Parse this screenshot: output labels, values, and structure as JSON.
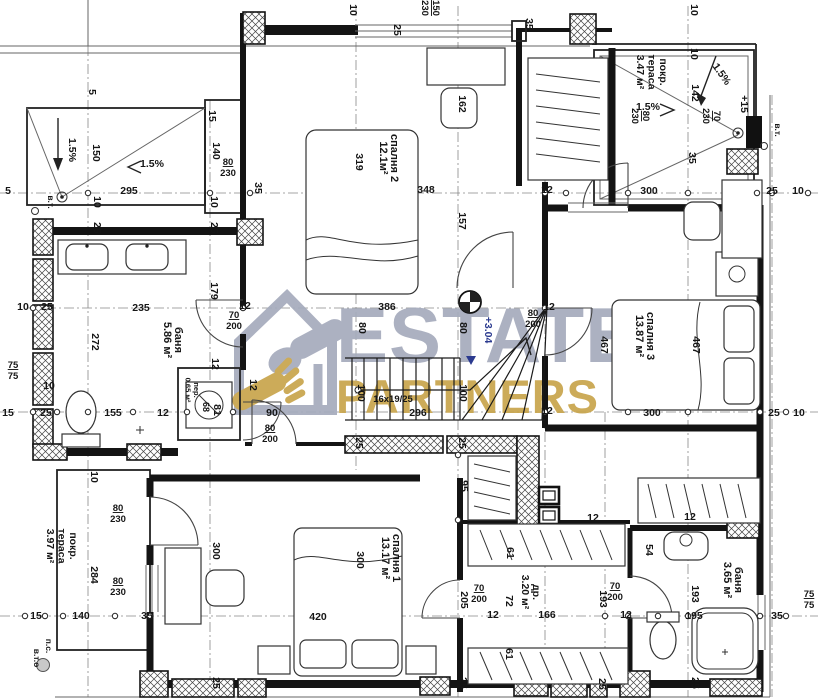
{
  "watermark": {
    "line1": "ESTATE",
    "line2": "PARTNERS",
    "gray": "#a6abbc",
    "gold": "#c8a44c"
  },
  "plan": {
    "rooms_note": "Bulgarian room labels: спалня=bedroom, баня=bathroom, покр. тераса=covered terrace, др.=closet, пер.=laundry",
    "labels": [
      {
        "t": "10",
        "x": 350,
        "y": 10,
        "r": 90
      },
      {
        "t": "25",
        "x": 394,
        "y": 30,
        "r": 90
      },
      {
        "ls": [
          "150",
          "230"
        ],
        "x": 433,
        "y": 8,
        "r": 90,
        "u": 1,
        "s": 9.5
      },
      {
        "t": "35",
        "x": 526,
        "y": 24,
        "r": 90
      },
      {
        "t": "10",
        "x": 691,
        "y": 10,
        "r": 90
      },
      {
        "t": "10",
        "x": 691,
        "y": 54,
        "r": 90
      },
      {
        "t": "1.5%",
        "x": 719,
        "y": 76,
        "r": 55
      },
      {
        "t": "142",
        "x": 692,
        "y": 93,
        "r": 90
      },
      {
        "t": "+15",
        "x": 741,
        "y": 104,
        "r": 90
      },
      {
        "t": "в.т.",
        "x": 775,
        "y": 130,
        "r": 90,
        "s": 8.5
      },
      {
        "ls": [
          "80",
          "230"
        ],
        "x": 643,
        "y": 116,
        "r": 90,
        "u": 1,
        "s": 9.5
      },
      {
        "ls": [
          "70",
          "230"
        ],
        "x": 714,
        "y": 116,
        "r": 90,
        "u": 1,
        "s": 9.5
      },
      {
        "t": "1.5%",
        "x": 648,
        "y": 110,
        "r": 0
      },
      {
        "t": "35",
        "x": 689,
        "y": 158,
        "r": 90
      },
      {
        "ls": [
          "покр.",
          "тераса",
          "3.47 м²"
        ],
        "x": 660,
        "y": 72,
        "r": 90,
        "n": "room-label",
        "s": 10.5,
        "lh": 11.5
      },
      {
        "t": "300",
        "x": 649,
        "y": 194,
        "r": 0
      },
      {
        "t": "25",
        "x": 772,
        "y": 194,
        "r": 0
      },
      {
        "t": "10",
        "x": 798,
        "y": 194,
        "r": 0
      },
      {
        "t": "5",
        "x": 89,
        "y": 92,
        "r": 90
      },
      {
        "t": "15",
        "x": 209,
        "y": 116,
        "r": 90
      },
      {
        "t": "1.5%",
        "x": 69,
        "y": 150,
        "r": 90
      },
      {
        "t": "150",
        "x": 93,
        "y": 153,
        "r": 90
      },
      {
        "t": "140",
        "x": 213,
        "y": 151,
        "r": 90
      },
      {
        "ls": [
          "80",
          "230"
        ],
        "x": 228,
        "y": 165,
        "r": 0,
        "u": 1,
        "s": 9.5
      },
      {
        "t": "1.5%",
        "x": 152,
        "y": 167,
        "r": 0
      },
      {
        "t": "295",
        "x": 129,
        "y": 194,
        "r": 0
      },
      {
        "t": "35",
        "x": 255,
        "y": 188,
        "r": 90
      },
      {
        "t": "5",
        "x": 8,
        "y": 194,
        "r": 0
      },
      {
        "t": "в.т.",
        "x": 48,
        "y": 202,
        "r": 90,
        "s": 8.5
      },
      {
        "t": "10",
        "x": 94,
        "y": 202,
        "r": 90
      },
      {
        "t": "10",
        "x": 211,
        "y": 202,
        "r": 90
      },
      {
        "t": "25",
        "x": 94,
        "y": 228,
        "r": 90
      },
      {
        "t": "25",
        "x": 211,
        "y": 228,
        "r": 90
      },
      {
        "ls": [
          "спалня 2",
          "12.1м²"
        ],
        "x": 391,
        "y": 158,
        "r": 90,
        "n": "room-label",
        "s": 11
      },
      {
        "t": "319",
        "x": 356,
        "y": 162,
        "r": 90
      },
      {
        "t": "162",
        "x": 459,
        "y": 104,
        "r": 90
      },
      {
        "t": "348",
        "x": 426,
        "y": 193,
        "r": 0
      },
      {
        "t": "157",
        "x": 459,
        "y": 221,
        "r": 90
      },
      {
        "t": "12",
        "x": 547,
        "y": 193,
        "r": 0
      },
      {
        "t": "12",
        "x": 245,
        "y": 309,
        "r": 0
      },
      {
        "t": "386",
        "x": 387,
        "y": 310,
        "r": 0
      },
      {
        "t": "80",
        "x": 359,
        "y": 328,
        "r": 90
      },
      {
        "t": "80",
        "x": 460,
        "y": 328,
        "r": 90
      },
      {
        "t": "+3.04",
        "x": 485,
        "y": 330,
        "r": 90,
        "c": "lvl"
      },
      {
        "t": "12",
        "x": 549,
        "y": 310,
        "r": 0
      },
      {
        "ls": [
          "80",
          "200"
        ],
        "x": 533,
        "y": 316,
        "r": 0,
        "u": 1,
        "s": 9.5
      },
      {
        "t": "12",
        "x": 250,
        "y": 385,
        "r": 90
      },
      {
        "t": "90",
        "x": 272,
        "y": 416,
        "r": 0
      },
      {
        "t": "16x19/25",
        "x": 393,
        "y": 402,
        "r": 0,
        "s": 9.5
      },
      {
        "t": "100",
        "x": 358,
        "y": 393,
        "r": 90
      },
      {
        "t": "100",
        "x": 460,
        "y": 393,
        "r": 90
      },
      {
        "t": "296",
        "x": 418,
        "y": 416,
        "r": 0
      },
      {
        "t": "12",
        "x": 547,
        "y": 414,
        "r": 0
      },
      {
        "t": "25",
        "x": 356,
        "y": 443,
        "r": 90
      },
      {
        "t": "25",
        "x": 459,
        "y": 443,
        "r": 90
      },
      {
        "t": "95",
        "x": 461,
        "y": 486,
        "r": 90
      },
      {
        "t": "12",
        "x": 593,
        "y": 521,
        "r": 0
      },
      {
        "t": "12",
        "x": 690,
        "y": 520,
        "r": 0
      },
      {
        "t": "235",
        "x": 141,
        "y": 311,
        "r": 0
      },
      {
        "t": "179",
        "x": 211,
        "y": 291,
        "r": 90
      },
      {
        "ls": [
          "70",
          "200"
        ],
        "x": 234,
        "y": 318,
        "r": 0,
        "u": 1,
        "s": 9.5
      },
      {
        "ls": [
          "баня",
          "5.86 м²"
        ],
        "x": 175,
        "y": 340,
        "r": 90,
        "n": "room-label",
        "s": 11
      },
      {
        "t": "272",
        "x": 92,
        "y": 342,
        "r": 90
      },
      {
        "t": "12",
        "x": 212,
        "y": 364,
        "r": 90
      },
      {
        "ls": [
          "75",
          "75"
        ],
        "x": 13,
        "y": 368,
        "r": 0,
        "u": 1,
        "s": 9.5
      },
      {
        "t": "10",
        "x": 49,
        "y": 389,
        "r": 0
      },
      {
        "t": "155",
        "x": 113,
        "y": 416,
        "r": 0
      },
      {
        "t": "12",
        "x": 163,
        "y": 416,
        "r": 0
      },
      {
        "t": "15",
        "x": 8,
        "y": 416,
        "r": 0
      },
      {
        "t": "25",
        "x": 46,
        "y": 416,
        "r": 0
      },
      {
        "ls": [
          "пер.",
          "0.65 м²"
        ],
        "x": 194,
        "y": 390,
        "r": 90,
        "s": 7.5,
        "n": "room-label",
        "lh": 8.5
      },
      {
        "t": "68",
        "x": 203,
        "y": 407,
        "r": 90,
        "s": 9
      },
      {
        "t": "81",
        "x": 214,
        "y": 410,
        "r": 90
      },
      {
        "ls": [
          "80",
          "200"
        ],
        "x": 270,
        "y": 431,
        "r": 0,
        "u": 1,
        "s": 9.5
      },
      {
        "t": "10",
        "x": 91,
        "y": 477,
        "r": 90
      },
      {
        "ls": [
          "80",
          "230"
        ],
        "x": 118,
        "y": 511,
        "r": 0,
        "u": 1,
        "s": 9.5
      },
      {
        "ls": [
          "покр.",
          "тераса",
          "3.97 м²"
        ],
        "x": 70,
        "y": 546,
        "r": 90,
        "n": "room-label",
        "s": 10.5,
        "lh": 11.5
      },
      {
        "t": "284",
        "x": 91,
        "y": 575,
        "r": 90
      },
      {
        "ls": [
          "80",
          "230"
        ],
        "x": 118,
        "y": 584,
        "r": 0,
        "u": 1,
        "s": 9.5
      },
      {
        "t": "15",
        "x": 36,
        "y": 619,
        "r": 0
      },
      {
        "t": "140",
        "x": 81,
        "y": 619,
        "r": 0
      },
      {
        "t": "35",
        "x": 147,
        "y": 619,
        "r": 0
      },
      {
        "t": "300",
        "x": 213,
        "y": 551,
        "r": 90
      },
      {
        "t": "п.с.",
        "x": 46,
        "y": 646,
        "r": 90,
        "s": 8.5
      },
      {
        "t": "в.т.о",
        "x": 34,
        "y": 658,
        "r": 90,
        "s": 8.5
      },
      {
        "t": "25",
        "x": 213,
        "y": 683,
        "r": 90
      },
      {
        "ls": [
          "спалня 1",
          "13.17 м²"
        ],
        "x": 393,
        "y": 558,
        "r": 90,
        "n": "room-label",
        "s": 11
      },
      {
        "t": "300",
        "x": 357,
        "y": 560,
        "r": 90
      },
      {
        "t": "420",
        "x": 318,
        "y": 620,
        "r": 0
      },
      {
        "t": "205",
        "x": 461,
        "y": 600,
        "r": 90
      },
      {
        "ls": [
          "70",
          "200"
        ],
        "x": 479,
        "y": 591,
        "r": 0,
        "u": 1,
        "s": 9.5
      },
      {
        "t": "12",
        "x": 493,
        "y": 618,
        "r": 0
      },
      {
        "t": "72",
        "x": 506,
        "y": 601,
        "r": 90
      },
      {
        "ls": [
          "др.",
          "3.20 м²"
        ],
        "x": 533,
        "y": 592,
        "r": 90,
        "n": "room-label",
        "s": 10.5
      },
      {
        "t": "166",
        "x": 547,
        "y": 618,
        "r": 0
      },
      {
        "t": "61",
        "x": 506,
        "y": 654,
        "r": 90
      },
      {
        "t": "61",
        "x": 507,
        "y": 553,
        "r": 90
      },
      {
        "t": "25",
        "x": 460,
        "y": 683,
        "r": 90
      },
      {
        "t": "25",
        "x": 599,
        "y": 684,
        "r": 90
      },
      {
        "t": "54",
        "x": 646,
        "y": 550,
        "r": 90
      },
      {
        "t": "193",
        "x": 600,
        "y": 599,
        "r": 90
      },
      {
        "ls": [
          "70",
          "200"
        ],
        "x": 615,
        "y": 589,
        "r": 0,
        "u": 1,
        "s": 9.5
      },
      {
        "t": "12",
        "x": 626,
        "y": 618,
        "r": 0
      },
      {
        "ls": [
          "баня",
          "3.65 м²"
        ],
        "x": 735,
        "y": 580,
        "r": 90,
        "n": "room-label",
        "s": 11
      },
      {
        "t": "193",
        "x": 692,
        "y": 594,
        "r": 90
      },
      {
        "t": "195",
        "x": 694,
        "y": 619,
        "r": 0
      },
      {
        "t": "35",
        "x": 777,
        "y": 619,
        "r": 0
      },
      {
        "ls": [
          "75",
          "75"
        ],
        "x": 809,
        "y": 597,
        "r": 0,
        "u": 1,
        "s": 9.5
      },
      {
        "t": "25",
        "x": 692,
        "y": 683,
        "r": 90
      },
      {
        "t": "467",
        "x": 601,
        "y": 345,
        "r": 90
      },
      {
        "ls": [
          "спалня 3",
          "13.87 м²"
        ],
        "x": 647,
        "y": 336,
        "r": 90,
        "n": "room-label",
        "s": 11
      },
      {
        "t": "467",
        "x": 693,
        "y": 345,
        "r": 90
      },
      {
        "t": "300",
        "x": 652,
        "y": 416,
        "r": 0
      },
      {
        "t": "25",
        "x": 774,
        "y": 416,
        "r": 0
      },
      {
        "t": "10",
        "x": 799,
        "y": 416,
        "r": 0
      },
      {
        "t": "10",
        "x": 23,
        "y": 310,
        "r": 0
      },
      {
        "t": "25",
        "x": 47,
        "y": 310,
        "r": 0
      }
    ]
  }
}
